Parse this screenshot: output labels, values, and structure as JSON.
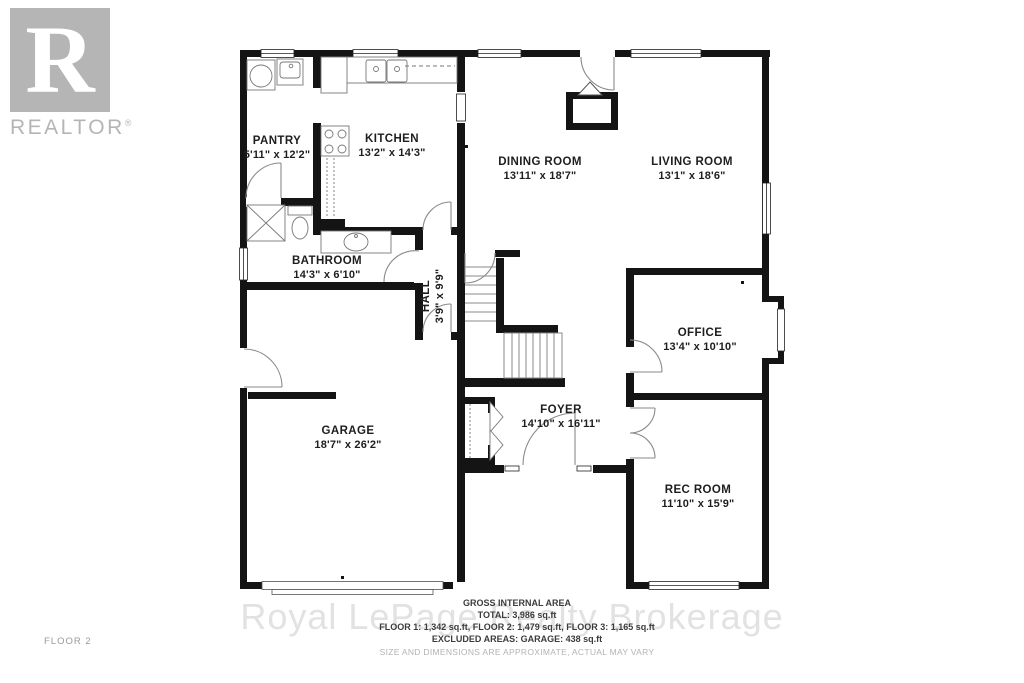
{
  "branding": {
    "logo_letter": "R",
    "wordmark": "REALTOR",
    "registered_mark": "®"
  },
  "watermark_text": "Royal LePage Realty Brokerage",
  "floor_page_label": "FLOOR 2",
  "rooms": {
    "pantry": {
      "name": "PANTRY",
      "dims": "5'11\" x 12'2\""
    },
    "kitchen": {
      "name": "KITCHEN",
      "dims": "13'2\" x 14'3\""
    },
    "dining": {
      "name": "DINING ROOM",
      "dims": "13'11\" x 18'7\""
    },
    "living": {
      "name": "LIVING ROOM",
      "dims": "13'1\" x 18'6\""
    },
    "bathroom": {
      "name": "BATHROOM",
      "dims": "14'3\" x 6'10\""
    },
    "hall": {
      "name": "HALL",
      "dims": "3'9\" x 9'9\""
    },
    "office": {
      "name": "OFFICE",
      "dims": "13'4\" x 10'10\""
    },
    "garage": {
      "name": "GARAGE",
      "dims": "18'7\" x 26'2\""
    },
    "foyer": {
      "name": "FOYER",
      "dims": "14'10\" x 16'11\""
    },
    "rec": {
      "name": "REC ROOM",
      "dims": "11'10\" x 15'9\""
    }
  },
  "footer": {
    "title": "GROSS INTERNAL AREA",
    "total": "TOTAL: 3,986 sq.ft",
    "floors": "FLOOR 1: 1,342 sq.ft, FLOOR 2: 1,479 sq.ft, FLOOR 3: 1,165 sq.ft",
    "excluded": "EXCLUDED AREAS: GARAGE: 438 sq.ft",
    "disclaimer": "SIZE AND DIMENSIONS ARE APPROXIMATE, ACTUAL MAY VARY"
  }
}
